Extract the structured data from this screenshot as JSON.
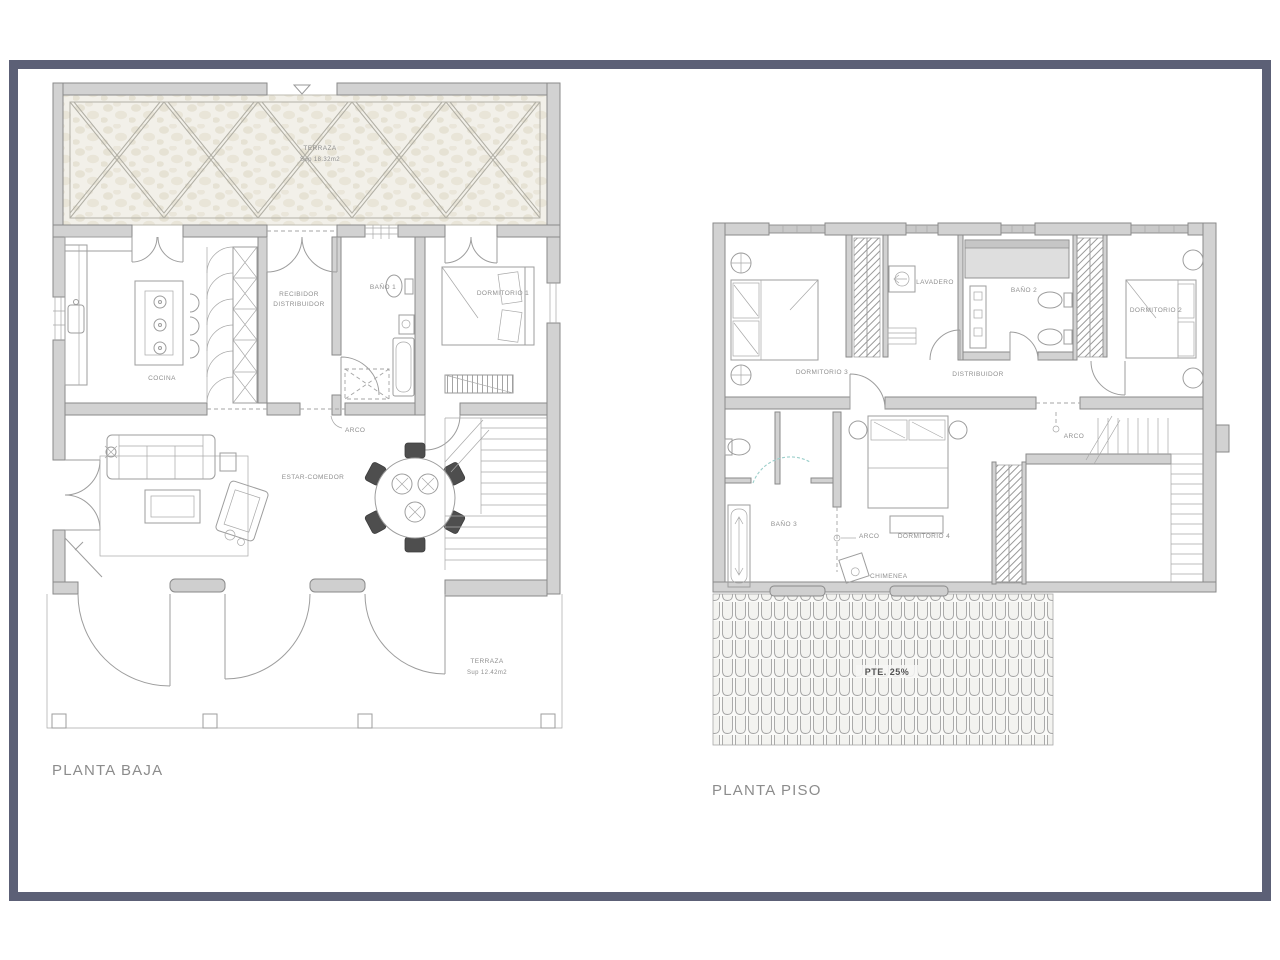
{
  "frame": {
    "border_color": "#5c6076"
  },
  "planta_baja": {
    "title": "PLANTA BAJA",
    "labels": {
      "terraza_top": "TERRAZA",
      "terraza_top_area": "Sup 18.32m2",
      "cocina": "COCINA",
      "recibidor_line1": "RECIBIDOR",
      "recibidor_line2": "DISTRIBUIDOR",
      "bano1": "BAÑO 1",
      "dormitorio1": "DORMITORIO 1",
      "arco": "ARCO",
      "estar_comedor": "ESTAR-COMEDOR",
      "terraza_bottom": "TERRAZA",
      "terraza_bottom_area": "Sup 12.42m2"
    }
  },
  "planta_piso": {
    "title": "PLANTA PISO",
    "labels": {
      "dormitorio3": "DORMITORIO 3",
      "lavadero": "LAVADERO",
      "bano2": "BAÑO 2",
      "dormitorio2": "DORMITORIO 2",
      "distribuidor": "DISTRIBUIDOR",
      "arco_stairs": "ARCO",
      "bano3": "BAÑO 3",
      "arco_dorm4": "ARCO",
      "dormitorio4": "DORMITORIO 4",
      "chimenea": "CHIMENEA",
      "pendiente": "PTE. 25%"
    }
  }
}
